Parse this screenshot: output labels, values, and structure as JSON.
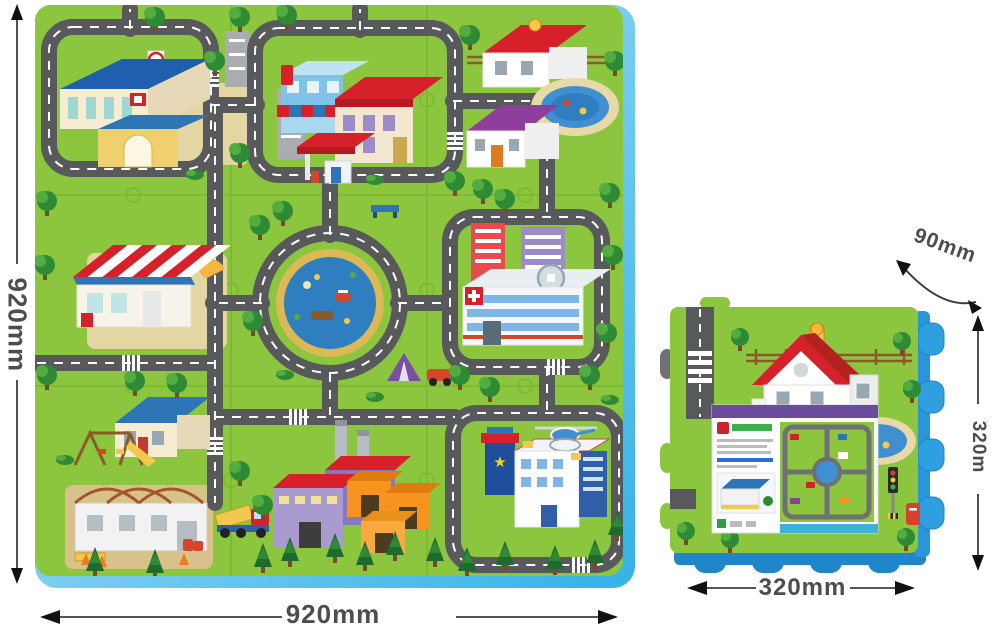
{
  "product_diagram": {
    "main_mat": {
      "name": "city-puzzle-play-mat",
      "height_label": "920mm",
      "width_label": "920mm",
      "scene_items": [
        "school",
        "shops",
        "gas-station",
        "houses-with-pool",
        "supermarket",
        "central-pond-roundabout",
        "hospital",
        "house-with-playground",
        "construction-site",
        "factory",
        "warehouses",
        "police-station",
        "helicopter",
        "roads",
        "trees"
      ]
    },
    "single_tile": {
      "name": "single-puzzle-tile-with-packaging",
      "thickness_label": "90mm",
      "side_label": "320m",
      "width_label": "320mm",
      "scene_items": [
        "house",
        "road",
        "pool",
        "packaging-card",
        "mini-mat-preview",
        "traffic-light",
        "postbox"
      ]
    },
    "colors": {
      "mat_green": "#8cc63e",
      "road_gray": "#58595b",
      "foam_edge_blue": "#2f9fe0",
      "pond_blue": "#2e7ec0",
      "dimension_text": "#4d4d4d"
    }
  }
}
